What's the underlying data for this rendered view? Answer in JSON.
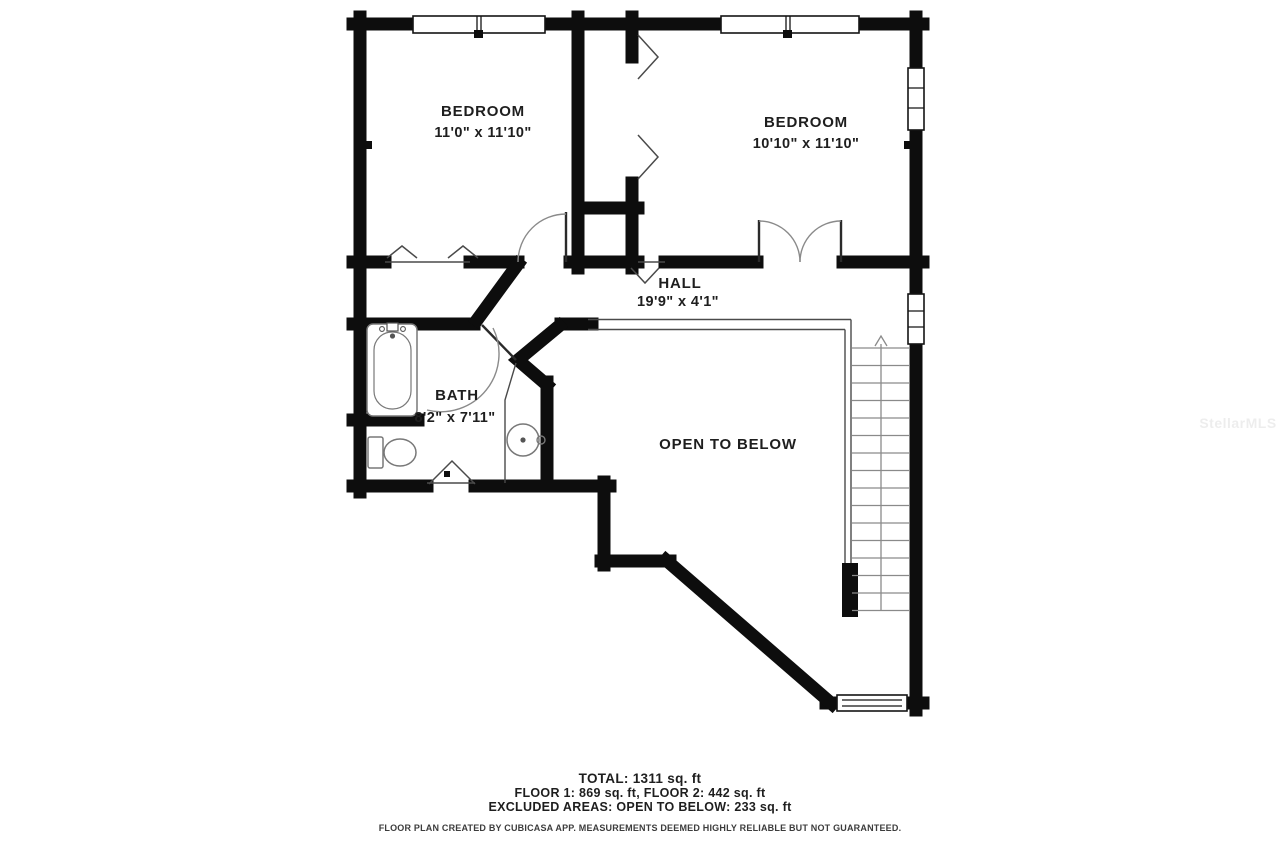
{
  "rooms": {
    "bedroom_left": {
      "name": "BEDROOM",
      "dims": "11'0\" x 11'10\""
    },
    "bedroom_right": {
      "name": "BEDROOM",
      "dims": "10'10\" x 11'10\""
    },
    "hall": {
      "name": "HALL",
      "dims": "19'9\" x 4'1\""
    },
    "bath": {
      "name": "BATH",
      "dims": "8'2\" x 7'11\""
    },
    "open_to_below": {
      "label": "OPEN TO BELOW"
    }
  },
  "summary": {
    "total": "TOTAL: 1311 sq. ft",
    "floors": "FLOOR 1: 869 sq. ft, FLOOR 2: 442 sq. ft",
    "excluded": "EXCLUDED AREAS: OPEN TO BELOW: 233 sq. ft"
  },
  "disclaimer": "FLOOR PLAN CREATED BY CUBICASA APP. MEASUREMENTS DEEMED HIGHLY RELIABLE BUT NOT GUARANTEED.",
  "watermark": "StellarMLS",
  "colors": {
    "wall": "#0d0d0d",
    "background": "#ffffff",
    "thin_line": "#4a4a4a",
    "fixture_line": "#787878"
  }
}
